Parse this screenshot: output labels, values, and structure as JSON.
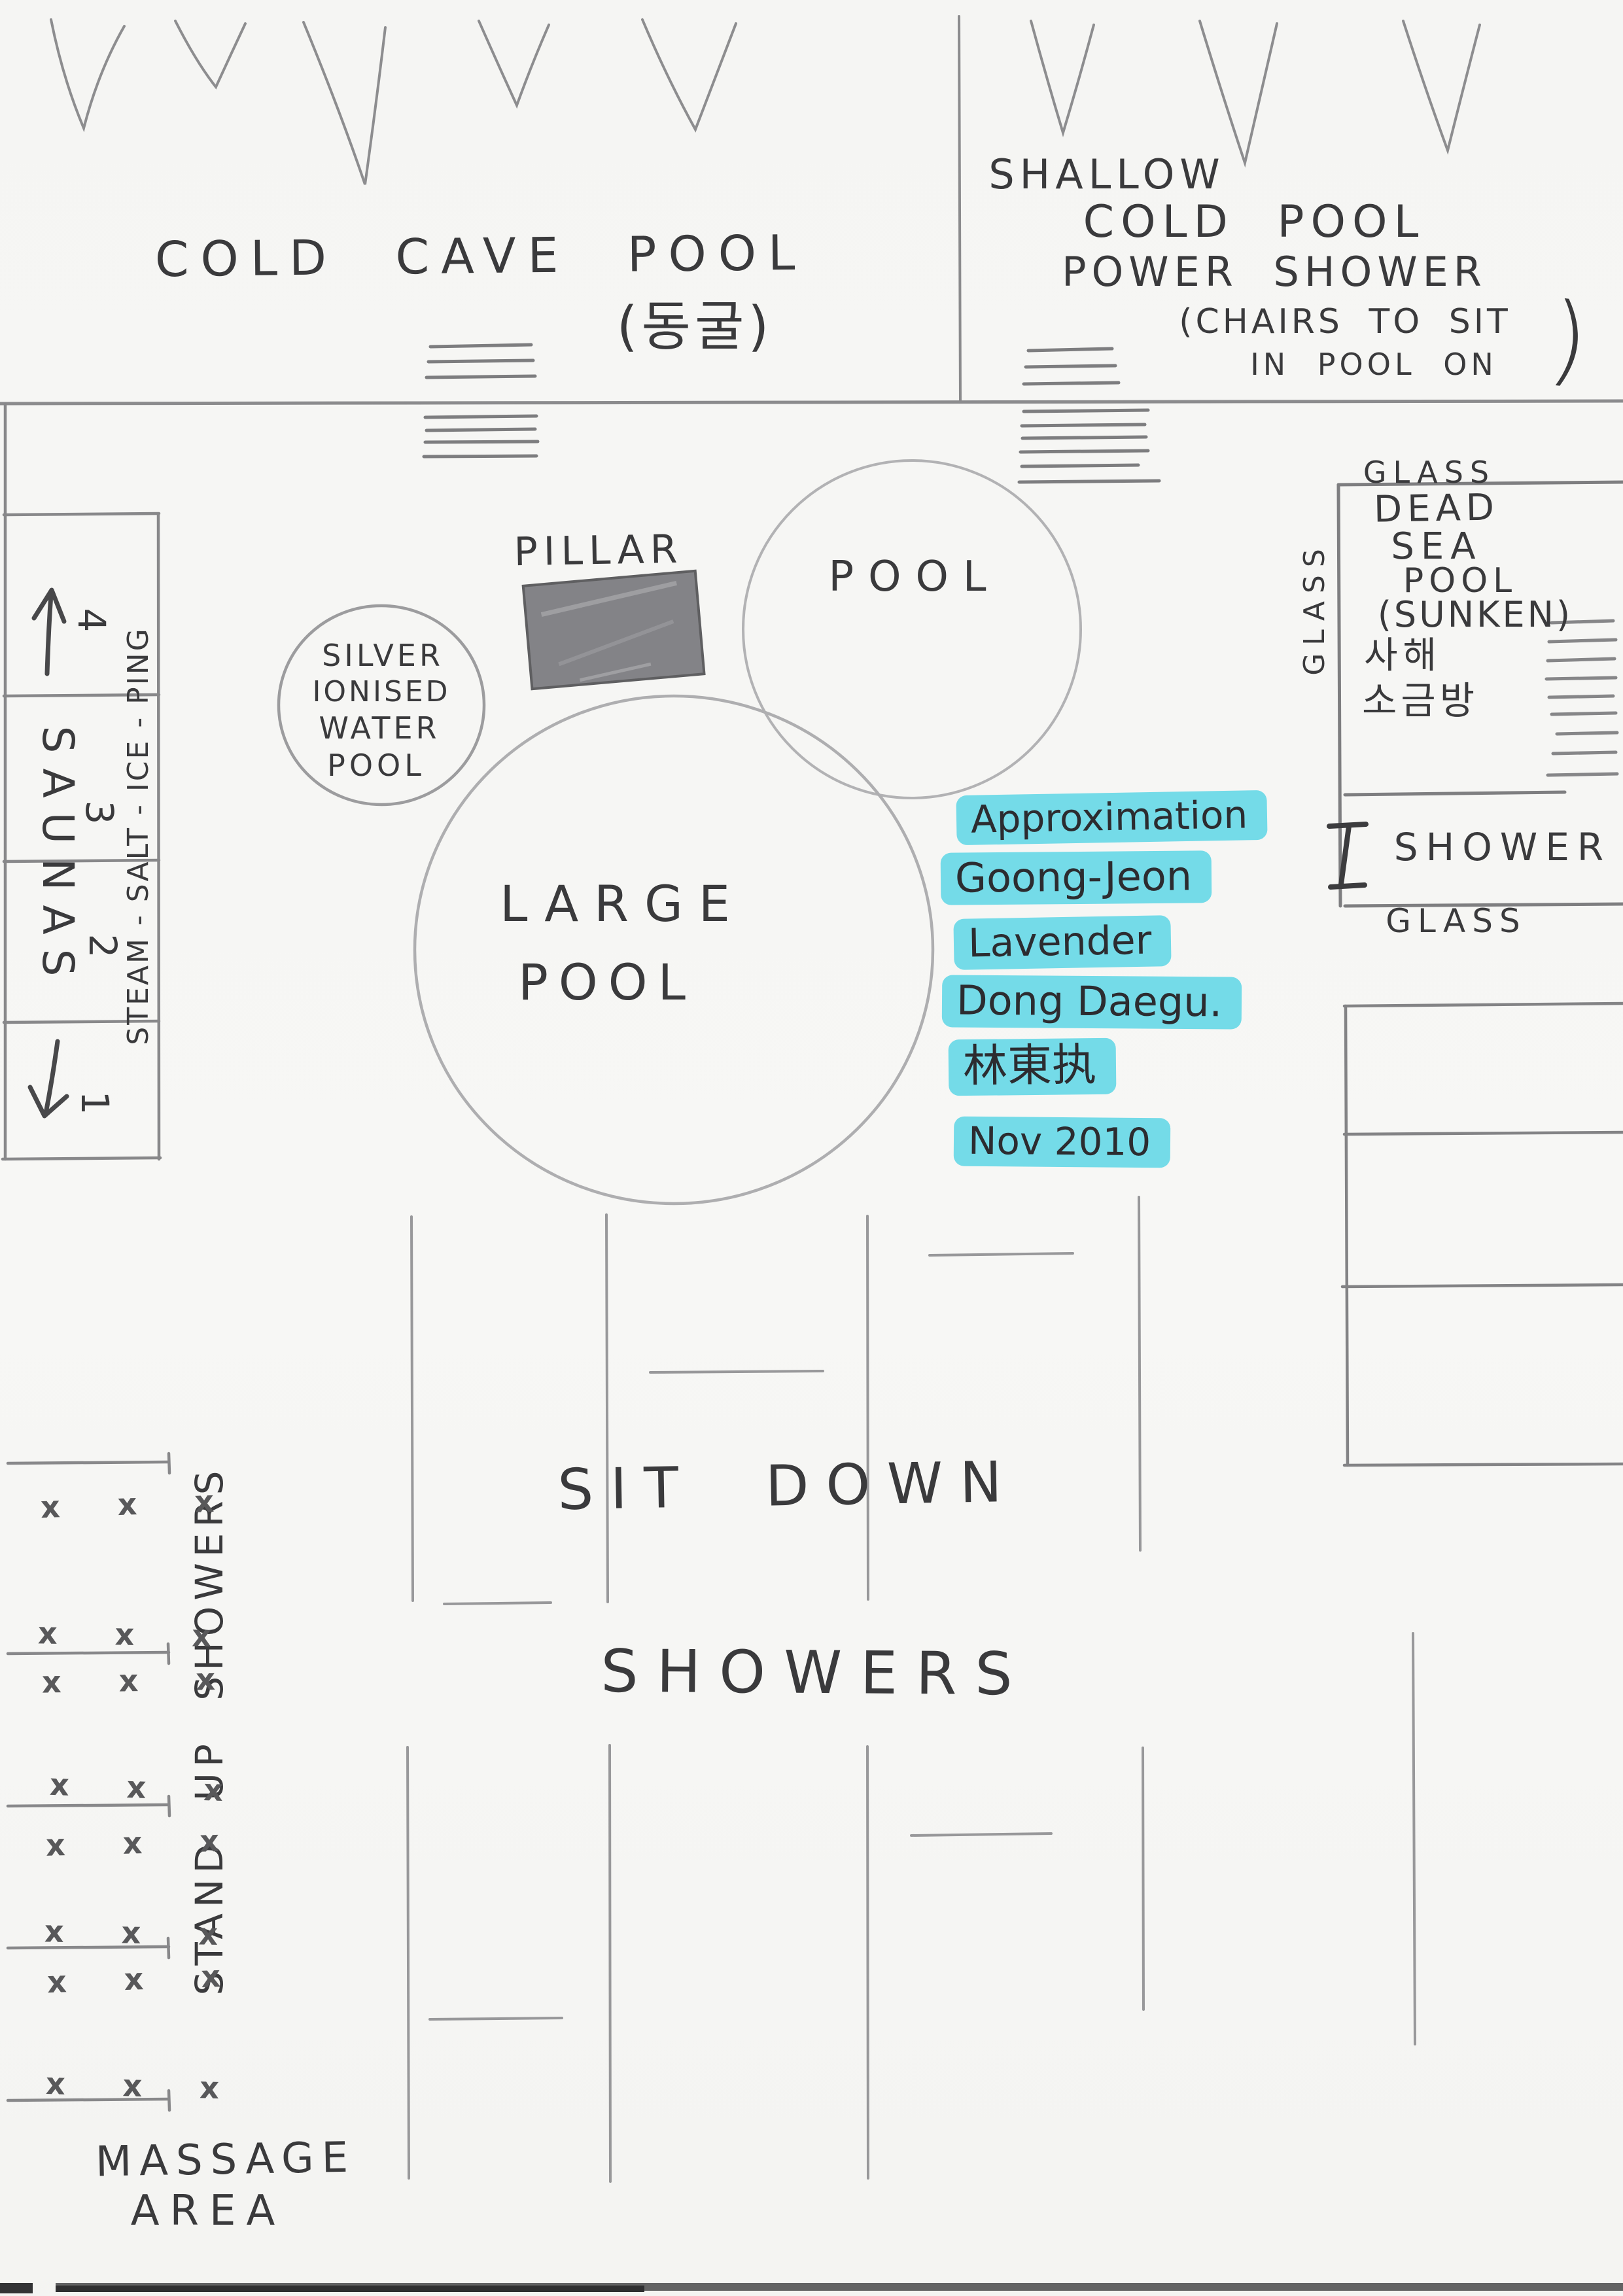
{
  "colors": {
    "highlight": "#74dbe8",
    "ink": "#35353a",
    "pencil": "#8d8d8f"
  },
  "labels": {
    "cold_cave": {
      "title": "COLD CAVE POOL",
      "korean": "(동굴)"
    },
    "shallow": {
      "l1": "SHALLOW",
      "l2": "COLD POOL",
      "l3": "POWER SHOWER",
      "l4": "(CHAIRS TO SIT",
      "l5": "IN POOL ON",
      "paren": ")"
    },
    "saunas": {
      "word": "SAUNAS",
      "n4": "4",
      "n3": "3",
      "n2": "2",
      "n1": "1",
      "side": "STEAM - SALT - ICE - PING"
    },
    "silver_pool": {
      "l1": "SILVER",
      "l2": "IONISED",
      "l3": "WATER",
      "l4": "POOL"
    },
    "pillar": "PILLAR",
    "pool": "POOL",
    "large_pool": {
      "l1": "LARGE",
      "l2": "POOL"
    },
    "note": {
      "l1": "Approximation",
      "l2": "Goong-Jeon",
      "l3": "Lavender",
      "l4": "Dong Daegu.",
      "l5": "林東执",
      "l6": "Nov 2010"
    },
    "dead_sea": {
      "glass_top": "GLASS",
      "glass_side": "GLASS",
      "l1": "DEAD",
      "l2": "SEA",
      "l3": "POOL",
      "l4": "(SUNKEN)",
      "kr1": "사해",
      "kr2": "소금방"
    },
    "shower": {
      "label": "SHOWER",
      "glass": "GLASS"
    },
    "sit_down": {
      "l1": "SIT DOWN",
      "l2": "SHOWERS"
    },
    "stand_up": "STAND UP SHOWERS",
    "massage": {
      "l1": "MASSAGE",
      "l2": "AREA"
    },
    "x_row": "x x x"
  }
}
